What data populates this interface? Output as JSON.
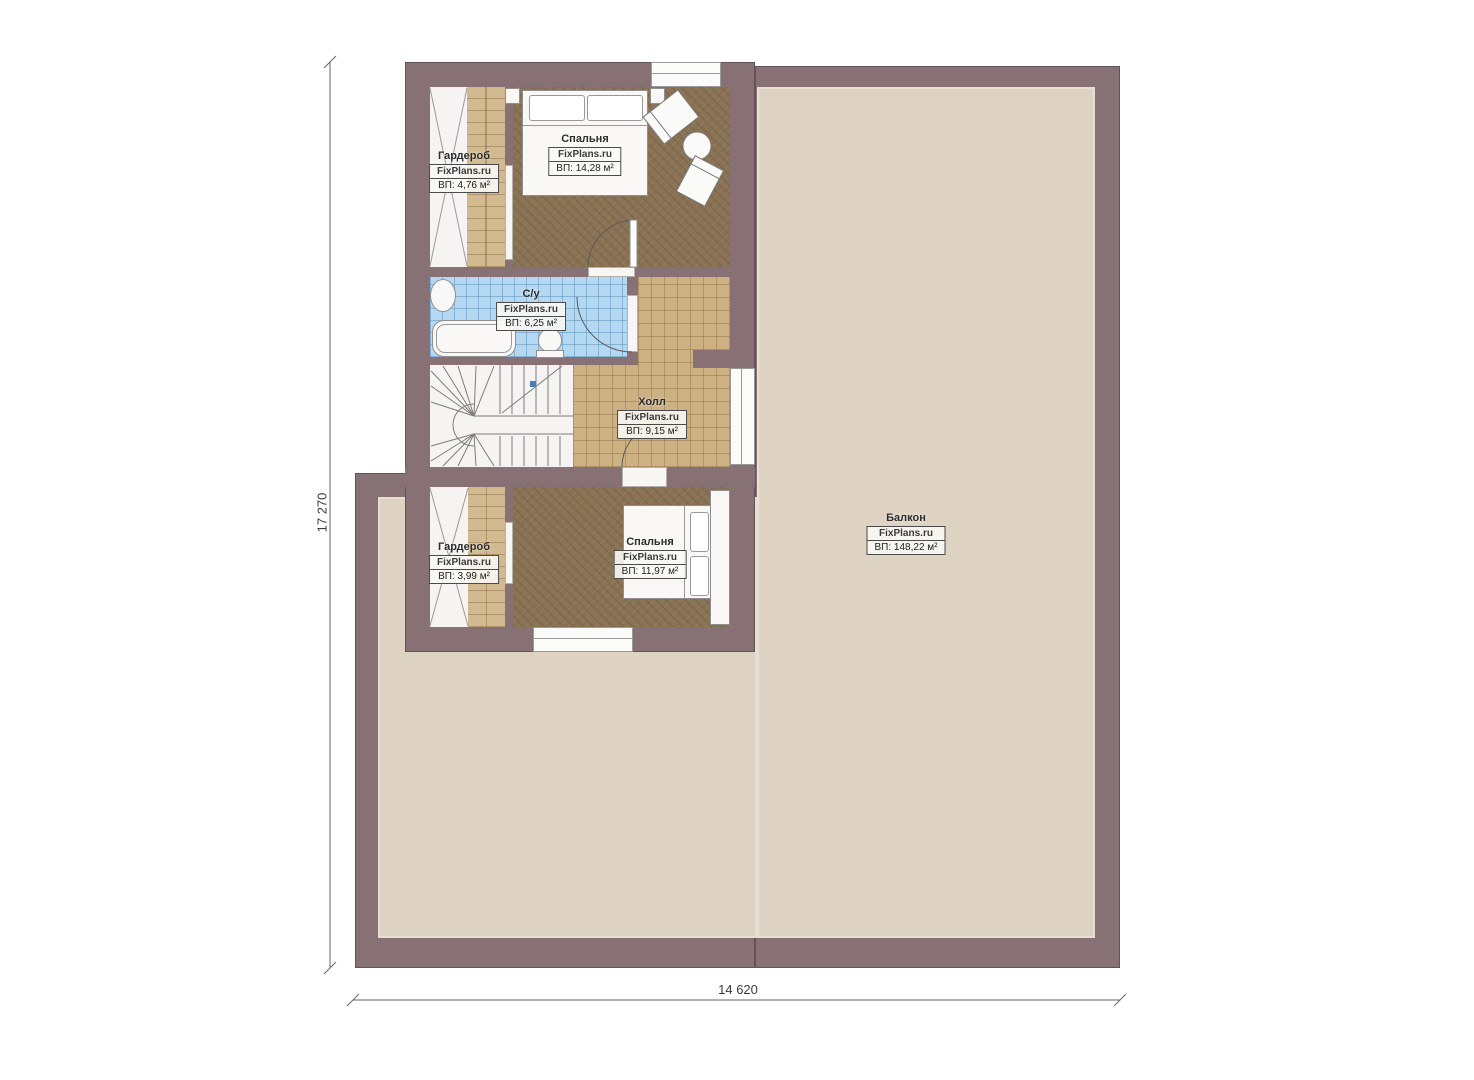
{
  "plan": {
    "watermark": "FixPlans.ru",
    "rooms": {
      "wardrobe_top": {
        "name": "Гардероб",
        "watermark": "FixPlans.ru",
        "area": "ВП: 4,76 м²"
      },
      "bedroom_top": {
        "name": "Спальня",
        "watermark": "FixPlans.ru",
        "area": "ВП: 14,28 м²"
      },
      "bathroom": {
        "name": "С/у",
        "watermark": "FixPlans.ru",
        "area": "ВП: 6,25 м²"
      },
      "hall": {
        "name": "Холл",
        "watermark": "FixPlans.ru",
        "area": "ВП: 9,15 м²"
      },
      "wardrobe_bottom": {
        "name": "Гардероб",
        "watermark": "FixPlans.ru",
        "area": "ВП: 3,99 м²"
      },
      "bedroom_bottom": {
        "name": "Спальня",
        "watermark": "FixPlans.ru",
        "area": "ВП: 11,97 м²"
      },
      "balcony": {
        "name": "Балкон",
        "watermark": "FixPlans.ru",
        "area": "ВП: 148,22 м²"
      }
    },
    "dimensions": {
      "height": "17 270",
      "width": "14 620"
    },
    "colors": {
      "wall": "#887174",
      "balcony_floor": "#ded3c2",
      "carpet": "#8a7254",
      "tile": "#cdb183",
      "bathroom": "#b5d8f2"
    }
  }
}
